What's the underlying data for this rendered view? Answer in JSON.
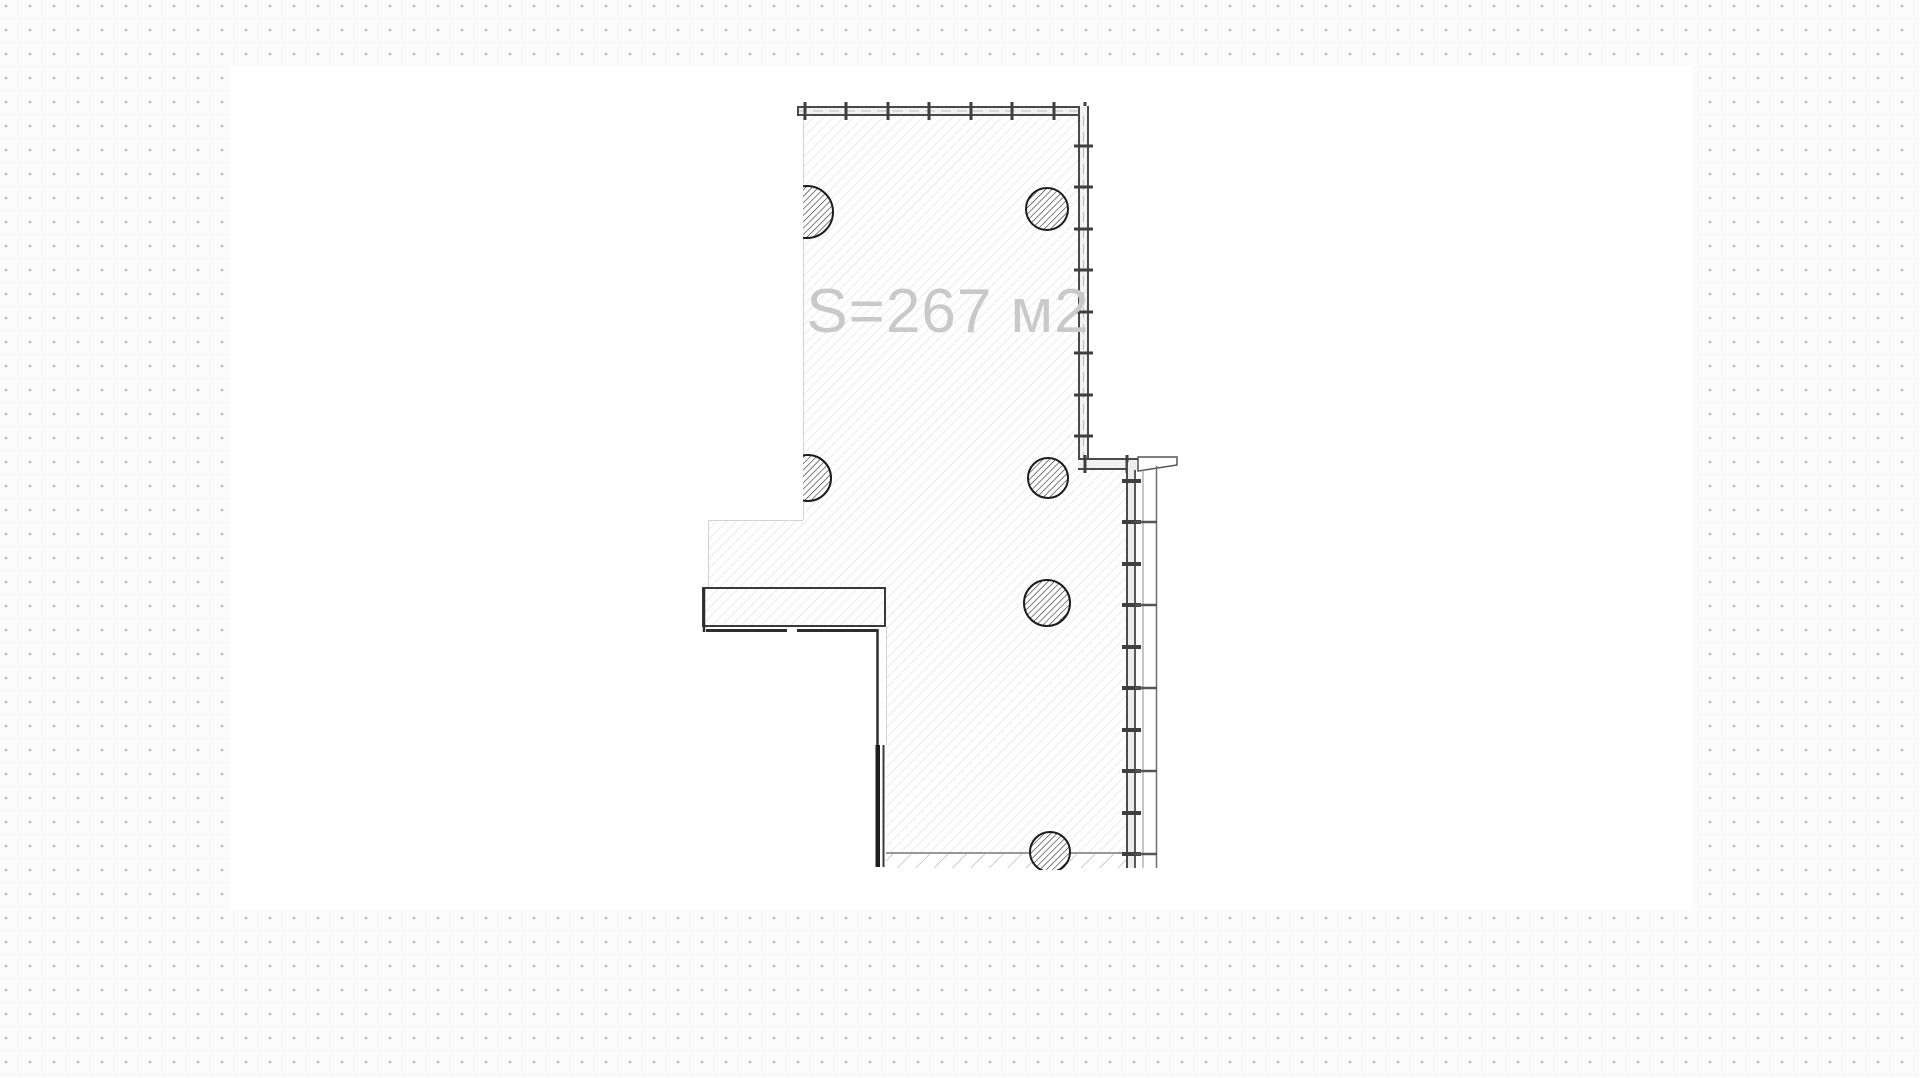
{
  "workspace": {
    "background_color": "#fbfbfb",
    "dot_color": "#b9b9b9",
    "dot_grid_px": 24
  },
  "canvas": {
    "x": 230,
    "y": 66,
    "width": 1462,
    "height": 844,
    "color": "#ffffff"
  },
  "plan": {
    "area_label": "S=267 м2",
    "label_color": "#c9c9c9",
    "label_x": 948,
    "label_y": 332,
    "hatch_color": "#e0e0e0",
    "column_hatch_color": "#2a2a2a",
    "slab_hatch_color": "#9e9e9e",
    "wall_color": "#4a4a4a",
    "tick_color": "#3f3f3f",
    "column_outline_color": "#1c1c1c",
    "columns": [
      {
        "cx": 807,
        "cy": 212,
        "r": 26,
        "clipped_left": true
      },
      {
        "cx": 1047,
        "cy": 209,
        "r": 21,
        "clipped_left": false
      },
      {
        "cx": 808,
        "cy": 478,
        "r": 23,
        "clipped_left": true
      },
      {
        "cx": 1048,
        "cy": 478,
        "r": 20,
        "clipped_left": false
      },
      {
        "cx": 1047,
        "cy": 603,
        "r": 23,
        "clipped_left": false
      },
      {
        "cx": 1050,
        "cy": 852,
        "r": 20,
        "clipped_left": false
      }
    ],
    "top_wall_ticks_x": [
      805,
      846,
      888,
      929,
      971,
      1012,
      1054,
      1085
    ],
    "right_wall_upper_ticks_y": [
      146,
      187,
      229,
      270,
      312,
      353,
      395,
      436
    ],
    "step_wall_ticks_x": [
      1085,
      1127
    ],
    "right_wall_lower_ticks_y": [
      481,
      522,
      564,
      605,
      647,
      688,
      730,
      771,
      813,
      854
    ],
    "panel_divider_ys": [
      522,
      605,
      688,
      771,
      854
    ]
  }
}
